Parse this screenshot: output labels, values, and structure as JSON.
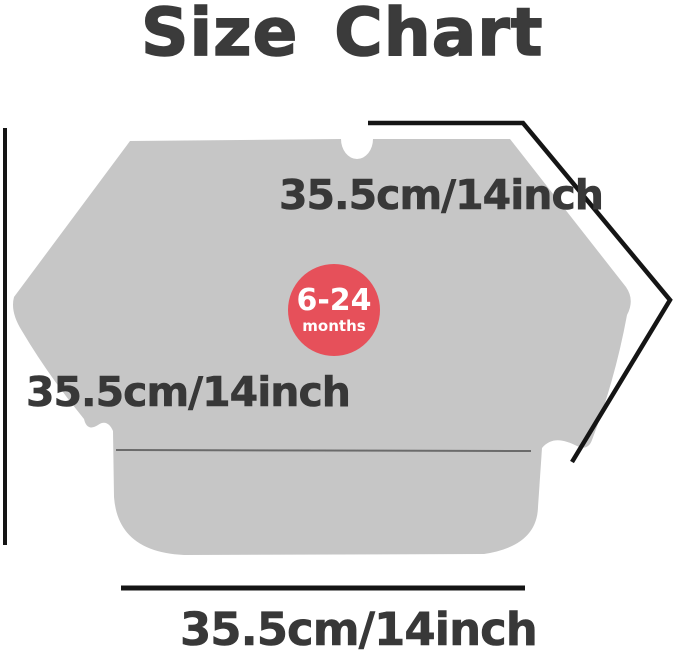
{
  "title": "Size Chart",
  "badge": {
    "age_range": "6-24",
    "unit": "months"
  },
  "labels": {
    "sleeve_measurement": "35.5cm/14inch",
    "height_measurement": "35.5cm/14inch",
    "width_measurement": "35.5cm/14inch"
  },
  "garment": {
    "type": "long-sleeve-baby-bib-silhouette",
    "features": [
      "neck-notch",
      "front-pocket-line",
      "spread-sleeves"
    ]
  },
  "colors": {
    "background": "#ffffff",
    "garment_fill": "#c6c6c6",
    "title_text": "#3b3b3b",
    "label_text": "#383838",
    "badge_fill": "#e6505a",
    "badge_text": "#ffffff",
    "dimension_line": "#151515",
    "pocket_line": "#6b6b6b"
  }
}
